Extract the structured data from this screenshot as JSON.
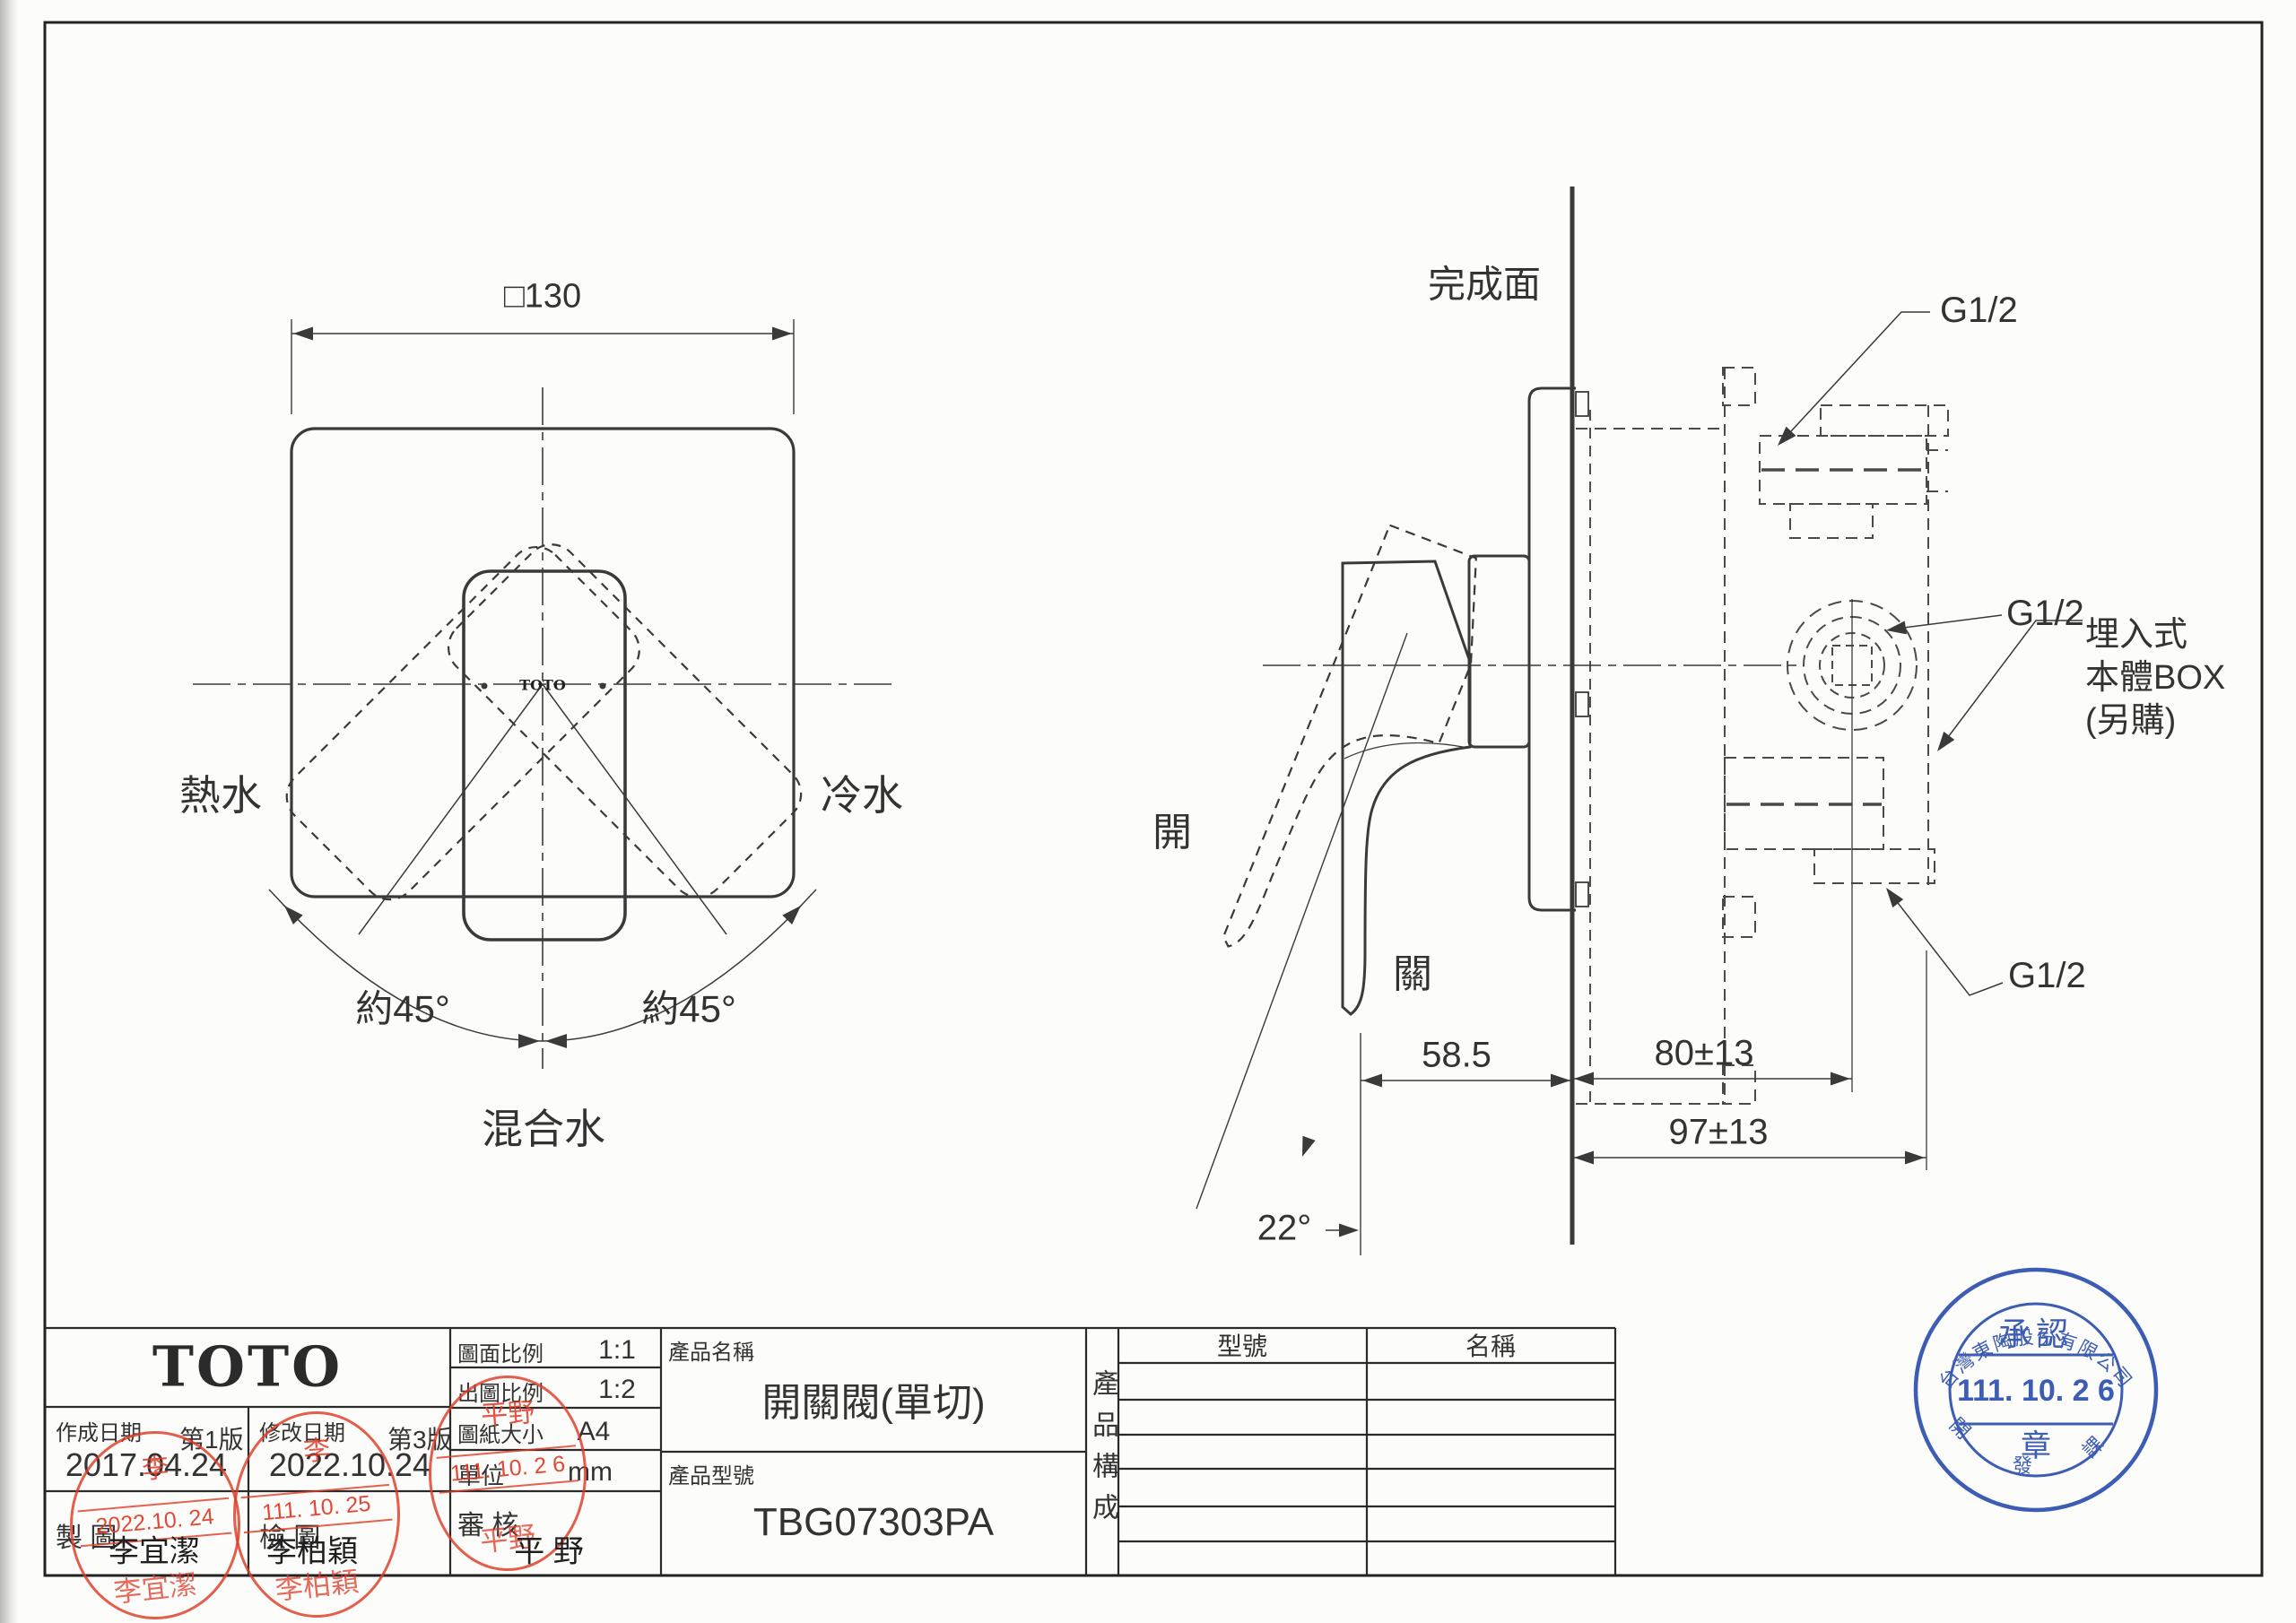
{
  "front_view": {
    "dim_width": "□130",
    "hot": "熱水",
    "cold": "冷水",
    "mixed": "混合水",
    "angle_left": "約45°",
    "angle_right": "約45°",
    "handle_logo": "TOTO"
  },
  "side_view": {
    "finished_surface": "完成面",
    "open": "開",
    "close": "關",
    "angle": "22°",
    "dim_offset": "58.5",
    "dim_depth": "80±13",
    "dim_total": "97±13",
    "thread_top": "G1/2",
    "thread_mid": "G1/2",
    "thread_bottom": "G1/2",
    "box_note_1": "埋入式",
    "box_note_2": "本體BOX",
    "box_note_3": "(另購)"
  },
  "title_block": {
    "logo": "TOTO",
    "scale_label": "圖面比例",
    "scale_value": "1:1",
    "plot_scale_label": "出圖比例",
    "plot_scale_value": "1:2",
    "paper_label": "圖紙大小",
    "paper_value": "A4",
    "unit_label": "單位",
    "unit_value": "mm",
    "review_label": "審  核",
    "reviewer_name": "平  野",
    "created_label": "作成日期",
    "created_version": "第1版",
    "created_date": "2017.04.24",
    "modified_label": "修改日期",
    "modified_version": "第3版",
    "modified_date": "2022.10.24",
    "drawn_label": "製  圖",
    "drawn_name": "李宜潔",
    "checked_label": "檢  圖",
    "checked_name": "李柏穎",
    "product_name_label": "產品名稱",
    "product_name": "開關閥(單切)",
    "product_code_label": "產品型號",
    "product_code": "TBG07303PA",
    "composition_label": "產品構成",
    "table_col_model": "型號",
    "table_col_name": "名稱",
    "table_rows": 6
  },
  "stamps": {
    "drawn": {
      "top": "李",
      "date": "2022.10. 24",
      "name": "李宜潔"
    },
    "checked": {
      "top": "李",
      "date": "111. 10. 25",
      "name": "李柏穎"
    },
    "review": {
      "top": "平野",
      "date": "111. 10. 2 6",
      "name": "平野"
    },
    "approval": {
      "company": "台灣東陶股份有限公司",
      "title": "承認",
      "date": "111. 10. 2 6",
      "seal": "章",
      "section": "開 發 課"
    }
  },
  "colors": {
    "line": "#3a3a3a",
    "red": "#de3a26",
    "blue": "#3d5db4"
  }
}
